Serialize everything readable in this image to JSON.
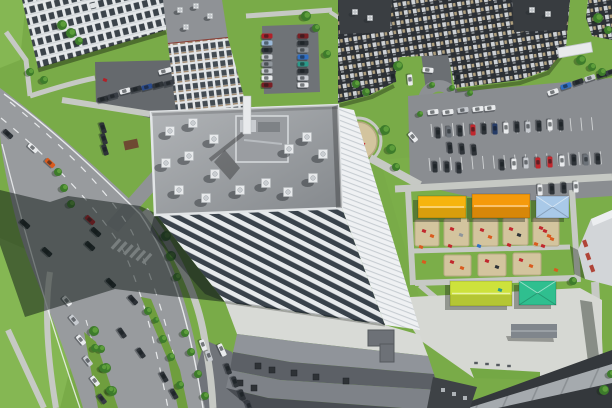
{
  "meta": {
    "type": "aerial-photo",
    "subject": "residential district with high-rise, avenue, parking lots and playgrounds"
  },
  "palette": {
    "grass": "#79ab48",
    "grassLight": "#85b753",
    "treeGreen": "#3d7b2b",
    "treeLight": "#5d9e3b",
    "road": "#989b9e",
    "roadDark": "#7e8184",
    "asphaltDark": "#65696d",
    "lotGray": "#8a8d91",
    "path": "#c6c9c4",
    "plaza": "#d6d8d3",
    "marking": "#f0f2f3",
    "roofLight": "#b2b5b8",
    "roofDark": "#84888c",
    "parapet": "#e2e5e7",
    "facadePier": "#e7eaec",
    "windowDark": "#39424b",
    "eastFace": "#eff1f3",
    "darkBuilding": "#2c3035",
    "checkerLight": "#ced2d6",
    "checkerTan": "#b0a07e",
    "slabWhite": "#e4e7e9",
    "towerCap": "#8f9296",
    "redTrim": "#8a3c34",
    "sand": "#d3c49e",
    "sandEdge": "#b7a983",
    "canopyYellow": "#f6b40e",
    "canopyOrange": "#f59a0b",
    "canopyBlue": "#a9c9e8",
    "canopyLime": "#cde23c",
    "canopyTeal": "#2fbf8f",
    "shedGray": "#80868c",
    "shedBrown": "#6e4a32",
    "bandWhite": "#d8dad6",
    "band1": "#90949a",
    "band2": "#5c6066",
    "band3": "#7e8288",
    "band4": "#494d53",
    "panelLight": "#a5aaae",
    "cornerDark": "#34383c",
    "shadow": "rgba(18,26,24,0.52)",
    "carShadow": "rgba(15,20,25,0.35)",
    "pinkBuilding": "#d2d5d8",
    "pinkAccent": "#b04438",
    "white": "#e9ebed"
  },
  "cars": [
    [
      8,
      134,
      42,
      "#2e3338"
    ],
    [
      33,
      148,
      42,
      "#e9ebed"
    ],
    [
      50,
      163,
      42,
      "#d95b1e"
    ],
    [
      25,
      224,
      42,
      "#23282c"
    ],
    [
      47,
      252,
      42,
      "#23282c"
    ],
    [
      90,
      220,
      42,
      "#b22028"
    ],
    [
      96,
      232,
      42,
      "#23282c"
    ],
    [
      90,
      246,
      42,
      "#23282c"
    ],
    [
      111,
      283,
      45,
      "#23282c"
    ],
    [
      133,
      300,
      48,
      "#2b3035"
    ],
    [
      122,
      333,
      55,
      "#2e3338"
    ],
    [
      141,
      353,
      55,
      "#2e3338"
    ],
    [
      164,
      377,
      60,
      "#2e3338"
    ],
    [
      174,
      394,
      60,
      "#30353a"
    ],
    [
      67,
      301,
      50,
      "#e9ebed"
    ],
    [
      74,
      320,
      50,
      "#c7cbd0"
    ],
    [
      81,
      340,
      50,
      "#e9ebed"
    ],
    [
      88,
      361,
      52,
      "#c7cbd0"
    ],
    [
      95,
      381,
      52,
      "#e9ebed"
    ],
    [
      102,
      399,
      52,
      "#383d44"
    ],
    [
      103,
      99,
      -15,
      "#2e3338"
    ],
    [
      113,
      96,
      -15,
      "#383d44"
    ],
    [
      125,
      91,
      -15,
      "#e9ebed"
    ],
    [
      136,
      89,
      -15,
      "#2e3338"
    ],
    [
      147,
      87,
      -15,
      "#2a4a8a"
    ],
    [
      158,
      85,
      -15,
      "#2e3338"
    ],
    [
      169,
      83,
      -15,
      "#383d44"
    ],
    [
      165,
      71,
      -15,
      "#e9ebed",
      13
    ],
    [
      103,
      128,
      72,
      "#2e3338"
    ],
    [
      104,
      139,
      72,
      "#30353a"
    ],
    [
      105,
      150,
      72,
      "#2e3338"
    ],
    [
      267,
      36,
      0,
      "#b22028"
    ],
    [
      267,
      43,
      0,
      "#9ab8d8"
    ],
    [
      267,
      50,
      0,
      "#2e3338"
    ],
    [
      267,
      57,
      0,
      "#c7cbd0"
    ],
    [
      267,
      64,
      0,
      "#8f959b"
    ],
    [
      267,
      71,
      0,
      "#c7cbd0"
    ],
    [
      267,
      78,
      0,
      "#e9ebed"
    ],
    [
      267,
      85,
      0,
      "#7a1f24"
    ],
    [
      303,
      36,
      0,
      "#7a1f24"
    ],
    [
      303,
      43,
      0,
      "#2e3338"
    ],
    [
      303,
      50,
      0,
      "#8f959b"
    ],
    [
      303,
      57,
      0,
      "#2f6fc4"
    ],
    [
      303,
      64,
      0,
      "#2a9a8a"
    ],
    [
      303,
      71,
      0,
      "#2e3338"
    ],
    [
      303,
      78,
      0,
      "#c7cbd0"
    ],
    [
      303,
      85,
      0,
      "#e9ebed"
    ],
    [
      393,
      77,
      80,
      "#2e3338"
    ],
    [
      410,
      80,
      85,
      "#e9ebed"
    ],
    [
      428,
      70,
      5,
      "#e9ebed"
    ],
    [
      458,
      78,
      88,
      "#2e3338"
    ],
    [
      433,
      112,
      -7,
      "#e9ebed"
    ],
    [
      448,
      112,
      -7,
      "#e9ebed"
    ],
    [
      463,
      110,
      -7,
      "#c7cbd0"
    ],
    [
      478,
      109,
      -7,
      "#e9ebed"
    ],
    [
      490,
      108,
      -7,
      "#e9ebed"
    ],
    [
      553,
      92,
      -18,
      "#e9ebed"
    ],
    [
      566,
      86,
      -18,
      "#2f6fc4"
    ],
    [
      578,
      82,
      -18,
      "#2e3338"
    ],
    [
      590,
      78,
      -18,
      "#c7cbd0"
    ],
    [
      602,
      75,
      -18,
      "#2e3338"
    ],
    [
      611,
      72,
      -18,
      "#383d44"
    ],
    [
      438,
      133,
      88,
      "#2e3338"
    ],
    [
      449,
      132,
      88,
      "#6b7178"
    ],
    [
      460,
      131,
      88,
      "#30353a"
    ],
    [
      473,
      130,
      88,
      "#c1272d"
    ],
    [
      484,
      129,
      88,
      "#2e3338"
    ],
    [
      495,
      129,
      88,
      "#253b66"
    ],
    [
      506,
      128,
      88,
      "#e9ebed"
    ],
    [
      517,
      127,
      88,
      "#30353a"
    ],
    [
      528,
      127,
      88,
      "#c7cbd0"
    ],
    [
      539,
      126,
      88,
      "#2e3338"
    ],
    [
      550,
      125,
      88,
      "#e9ebed"
    ],
    [
      561,
      125,
      88,
      "#30353a"
    ],
    [
      450,
      148,
      85,
      "#2e3338"
    ],
    [
      462,
      149,
      85,
      "#30353a"
    ],
    [
      474,
      150,
      85,
      "#2e3338"
    ],
    [
      413,
      137,
      50,
      "#e9ebed"
    ],
    [
      435,
      167,
      88,
      "#2e3338"
    ],
    [
      447,
      167,
      88,
      "#30353a"
    ],
    [
      459,
      168,
      88,
      "#2e3338"
    ],
    [
      502,
      165,
      88,
      "#30353a"
    ],
    [
      514,
      164,
      88,
      "#e9ebed"
    ],
    [
      526,
      163,
      88,
      "#c7cbd0"
    ],
    [
      538,
      163,
      88,
      "#c1272d"
    ],
    [
      550,
      162,
      88,
      "#c1272d"
    ],
    [
      562,
      161,
      88,
      "#e9ebed"
    ],
    [
      574,
      160,
      88,
      "#2e3338"
    ],
    [
      586,
      160,
      88,
      "#6b7178"
    ],
    [
      598,
      159,
      88,
      "#30353a"
    ],
    [
      540,
      190,
      88,
      "#e9ebed"
    ],
    [
      552,
      189,
      88,
      "#2e3338"
    ],
    [
      564,
      188,
      88,
      "#30353a"
    ],
    [
      576,
      187,
      88,
      "#e9ebed"
    ],
    [
      203,
      345,
      70,
      "#e9ebed"
    ],
    [
      209,
      356,
      70,
      "#c7cbd0"
    ],
    [
      222,
      350,
      65,
      "#e9ebed",
      13
    ],
    [
      228,
      369,
      70,
      "#2e3338"
    ],
    [
      235,
      382,
      70,
      "#30353a"
    ],
    [
      242,
      395,
      70,
      "#2e3338"
    ],
    [
      249,
      406,
      70,
      "#383d44"
    ]
  ],
  "trees": [
    [
      62,
      25,
      5
    ],
    [
      71,
      33,
      5
    ],
    [
      79,
      41,
      4
    ],
    [
      30,
      72,
      4
    ],
    [
      44,
      80,
      4
    ],
    [
      58,
      172,
      4
    ],
    [
      64,
      188,
      4
    ],
    [
      71,
      204,
      4
    ],
    [
      166,
      236,
      5
    ],
    [
      171,
      256,
      5
    ],
    [
      177,
      277,
      4
    ],
    [
      94,
      331,
      5
    ],
    [
      101,
      349,
      4
    ],
    [
      106,
      368,
      5
    ],
    [
      112,
      391,
      5
    ],
    [
      185,
      333,
      4
    ],
    [
      191,
      352,
      4
    ],
    [
      198,
      374,
      4
    ],
    [
      205,
      396,
      4
    ],
    [
      398,
      66,
      5
    ],
    [
      356,
      84,
      4
    ],
    [
      366,
      92,
      4
    ],
    [
      306,
      16,
      5
    ],
    [
      316,
      28,
      4
    ],
    [
      327,
      54,
      4
    ],
    [
      385,
      130,
      5
    ],
    [
      391,
      149,
      5
    ],
    [
      396,
      167,
      4
    ],
    [
      581,
      60,
      5
    ],
    [
      592,
      67,
      4
    ],
    [
      602,
      72,
      4
    ],
    [
      598,
      18,
      5
    ],
    [
      608,
      30,
      4
    ],
    [
      573,
      281,
      4
    ],
    [
      604,
      390,
      5
    ],
    [
      611,
      374,
      4
    ],
    [
      432,
      85,
      3
    ],
    [
      452,
      88,
      3
    ],
    [
      470,
      93,
      3
    ],
    [
      420,
      114,
      3
    ],
    [
      148,
      311,
      4
    ],
    [
      156,
      320,
      3
    ],
    [
      163,
      339,
      4
    ],
    [
      171,
      357,
      4
    ],
    [
      180,
      385,
      4
    ],
    [
      95,
      348,
      4
    ],
    [
      103,
      368,
      4
    ],
    [
      110,
      390,
      4
    ]
  ],
  "vents": [
    [
      170,
      131,
      9
    ],
    [
      193,
      123,
      9
    ],
    [
      214,
      139,
      9
    ],
    [
      166,
      163,
      9
    ],
    [
      189,
      156,
      9
    ],
    [
      215,
      174,
      9
    ],
    [
      240,
      190,
      9
    ],
    [
      266,
      183,
      9
    ],
    [
      289,
      149,
      9
    ],
    [
      307,
      137,
      9
    ],
    [
      323,
      154,
      9
    ],
    [
      313,
      178,
      9
    ],
    [
      288,
      192,
      9
    ],
    [
      206,
      198,
      9
    ],
    [
      179,
      190,
      9
    ],
    [
      180,
      10,
      5
    ],
    [
      196,
      6,
      5
    ],
    [
      210,
      16,
      5
    ],
    [
      186,
      27,
      5
    ],
    [
      355,
      12,
      5
    ],
    [
      370,
      18,
      5
    ],
    [
      532,
      10,
      5
    ],
    [
      548,
      14,
      5
    ]
  ],
  "canopies": [
    {
      "x": 418,
      "y": 196,
      "w": 48,
      "h": 22,
      "color": "#f6b40e",
      "type": "gable"
    },
    {
      "x": 472,
      "y": 194,
      "w": 58,
      "h": 24,
      "color": "#f59a0b",
      "type": "gable"
    },
    {
      "x": 536,
      "y": 196,
      "w": 33,
      "h": 22,
      "color": "#a9c9e8",
      "type": "hip"
    },
    {
      "x": 450,
      "y": 281,
      "w": 62,
      "h": 25,
      "color": "#cde23c",
      "type": "gable"
    },
    {
      "x": 519,
      "y": 281,
      "w": 37,
      "h": 24,
      "color": "#2fbf8f",
      "type": "hip"
    }
  ],
  "sand_plots": [
    [
      415,
      220,
      24,
      26
    ],
    [
      444,
      219,
      25,
      27
    ],
    [
      473,
      219,
      25,
      27
    ],
    [
      503,
      218,
      25,
      27
    ],
    [
      533,
      218,
      26,
      28
    ],
    [
      444,
      255,
      27,
      21
    ],
    [
      478,
      254,
      28,
      22
    ],
    [
      513,
      253,
      28,
      22
    ]
  ],
  "sand_circle": {
    "x": 358,
    "y": 141,
    "r": 19
  },
  "equipment": [
    [
      424,
      231,
      "#c1272d"
    ],
    [
      432,
      236,
      "#d95b1e"
    ],
    [
      452,
      229,
      "#c1272d"
    ],
    [
      461,
      235,
      "#8f959b"
    ],
    [
      482,
      230,
      "#c1272d"
    ],
    [
      490,
      237,
      "#d95b1e"
    ],
    [
      511,
      229,
      "#c1272d"
    ],
    [
      519,
      235,
      "#2e3338"
    ],
    [
      541,
      228,
      "#c1272d"
    ],
    [
      549,
      236,
      "#d95b1e"
    ],
    [
      421,
      247,
      "#d95b1e"
    ],
    [
      450,
      246,
      "#c1272d"
    ],
    [
      479,
      246,
      "#2f6fc4"
    ],
    [
      509,
      245,
      "#c1272d"
    ],
    [
      536,
      244,
      "#d95b1e"
    ],
    [
      452,
      262,
      "#c1272d"
    ],
    [
      462,
      268,
      "#d95b1e"
    ],
    [
      487,
      261,
      "#c1272d"
    ],
    [
      497,
      267,
      "#2e3338"
    ],
    [
      521,
      260,
      "#c1272d"
    ],
    [
      531,
      266,
      "#d95b1e"
    ],
    [
      556,
      270,
      "#d95b1e"
    ],
    [
      500,
      290,
      "#2a9a8a"
    ],
    [
      424,
      262,
      "#d95b1e"
    ],
    [
      363,
      144,
      "#c1272d"
    ],
    [
      352,
      136,
      "#d95b1e"
    ],
    [
      545,
      231,
      "#c1272d"
    ],
    [
      552,
      239,
      "#d95b1e"
    ],
    [
      543,
      246,
      "#c1272d"
    ],
    [
      105,
      80,
      "#b22028"
    ]
  ],
  "hvac_units": [
    [
      258,
      366
    ],
    [
      272,
      370
    ],
    [
      294,
      373
    ],
    [
      316,
      377
    ],
    [
      346,
      381
    ],
    [
      240,
      383
    ],
    [
      254,
      388
    ]
  ],
  "benches": [
    [
      476,
      363
    ],
    [
      487,
      364
    ],
    [
      498,
      365
    ],
    [
      509,
      366
    ]
  ],
  "stall_rows": [
    {
      "x": 431,
      "y": 124,
      "n": 16,
      "dx": 10.7,
      "dy": -0.45,
      "len": 13
    },
    {
      "x": 429,
      "y": 158,
      "n": 17,
      "dx": 10.7,
      "dy": -0.42,
      "len": 13
    }
  ],
  "zebra": {
    "x": 116,
    "y": 244,
    "n": 6,
    "dx": 6.2,
    "dy": 2.9,
    "angle": 42,
    "barw": 3.2,
    "barh": 12.5
  }
}
